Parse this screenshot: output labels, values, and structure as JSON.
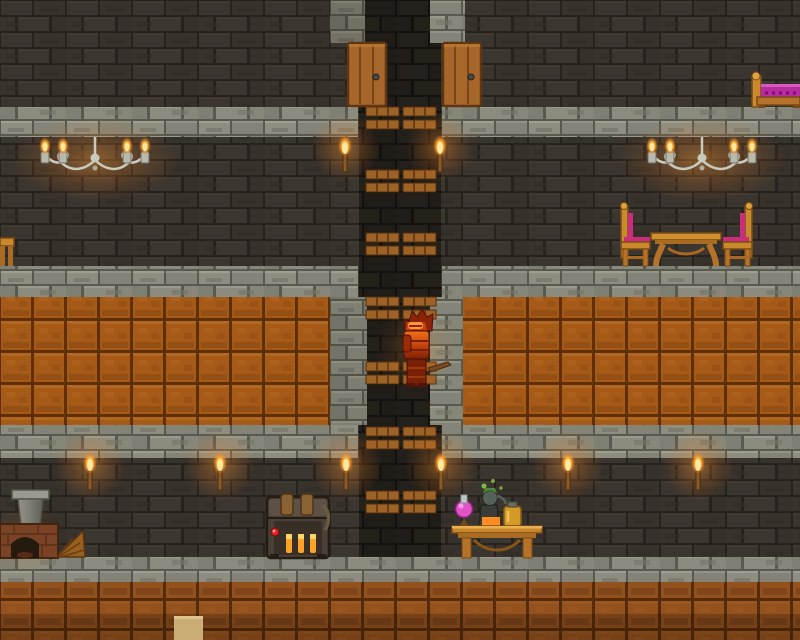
{
  "meta": {
    "type": "game-screenshot",
    "description": "Underground stone-brick base with a central vertical platform shaft, player in glowing orange armor, furnished rooms on multiple levels",
    "viewport": {
      "width": 800,
      "height": 640
    }
  },
  "palette": {
    "wall_brick": "#37322b",
    "shaft_brick": "#211e1a",
    "stone_slab": "#8b8c7e",
    "ore_block": "#a65a18",
    "ore_block_dark": "#8a4a1a",
    "door_wood": "#a8672a",
    "platform_wood": "#9c6226",
    "gold_wood": "#ca8a2c",
    "cushion_pink": "#cc2c7c",
    "blanket_magenta": "#b82aa0",
    "sand_block": "#c9ad74",
    "indicator_red": "#e62222",
    "vent_glow": "#ffa227",
    "flame_orange": "#ffb236",
    "potion_pink": "#e054c8",
    "potion_green": "#4e8a34",
    "potion_amber": "#d49a28",
    "furnace_brick": "#7b4326",
    "chandelier_silver": "#c9cabf",
    "armor_orange": "#e25b12"
  },
  "scene": {
    "levels": {
      "floor_y_positions": [
        107,
        266,
        425,
        557
      ],
      "orange_band": {
        "y": 297,
        "height": 128
      },
      "bottom_orange_band": {
        "y": 582,
        "height": 58
      }
    },
    "objects": {
      "doors": [
        {
          "x": 348,
          "y": 43
        },
        {
          "x": 443,
          "y": 43
        }
      ],
      "platform_cluster_y": [
        107,
        170,
        233,
        297,
        362,
        427,
        491
      ],
      "platform_x_span": [
        366,
        438
      ],
      "upper_torch_x": [
        345,
        440
      ],
      "lower_torch_x": [
        90,
        220,
        346,
        441,
        568,
        698
      ],
      "chandelier_center_x": [
        95,
        702
      ],
      "player": {
        "x": 403,
        "y": 309,
        "width": 27,
        "height": 78,
        "description": "character in glowing orange armor, facing right, holding a wooden-handled tool"
      },
      "chest": {
        "x": 267,
        "y": 495,
        "note": "dark metal chest, two straps, three glowing vents, red indicator light"
      },
      "furnace": {
        "x": 0,
        "y": 490,
        "note": "brick furnace with chimney and wooden bellows"
      },
      "alchemy_table": {
        "x": 452,
        "y": 480,
        "note": "golden table with pink flask, bubbling still, amber jar"
      },
      "dining_set": {
        "x": 620,
        "y": 205,
        "note": "two gold chairs with pink cushions and a gold table"
      },
      "bed": {
        "x": 752,
        "y": 75,
        "note": "gold-framed bed with magenta blanket, cut off at right edge"
      },
      "sand_block": {
        "x": 174,
        "y": 616
      },
      "edge_furniture": {
        "x": 0,
        "y": 238,
        "note": "golden furniture piece cut off at left edge"
      }
    }
  }
}
